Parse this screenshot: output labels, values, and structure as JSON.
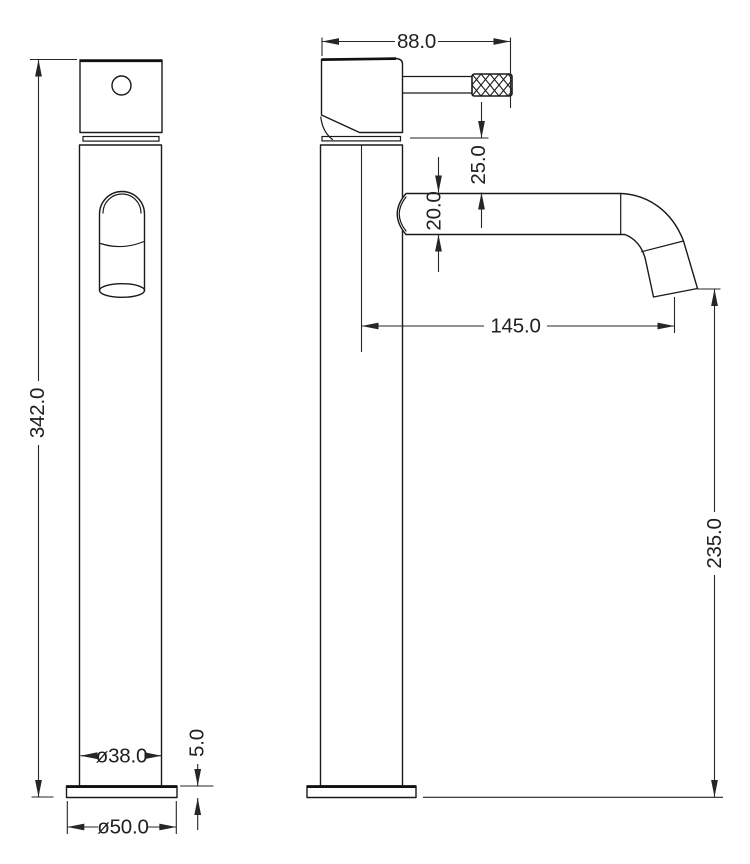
{
  "drawing": {
    "background_color": "#ffffff",
    "line_color": "#1a1a1a",
    "dimension_color": "#262626",
    "dimensions": {
      "overall_height": "342.0",
      "body_diameter": "ø38.0",
      "base_diameter": "ø50.0",
      "base_thickness": "5.0",
      "head_width": "88.0",
      "spout_drop": "25.0",
      "spout_diameter": "20.0",
      "spout_reach": "145.0",
      "spout_outlet_height": "235.0"
    }
  }
}
